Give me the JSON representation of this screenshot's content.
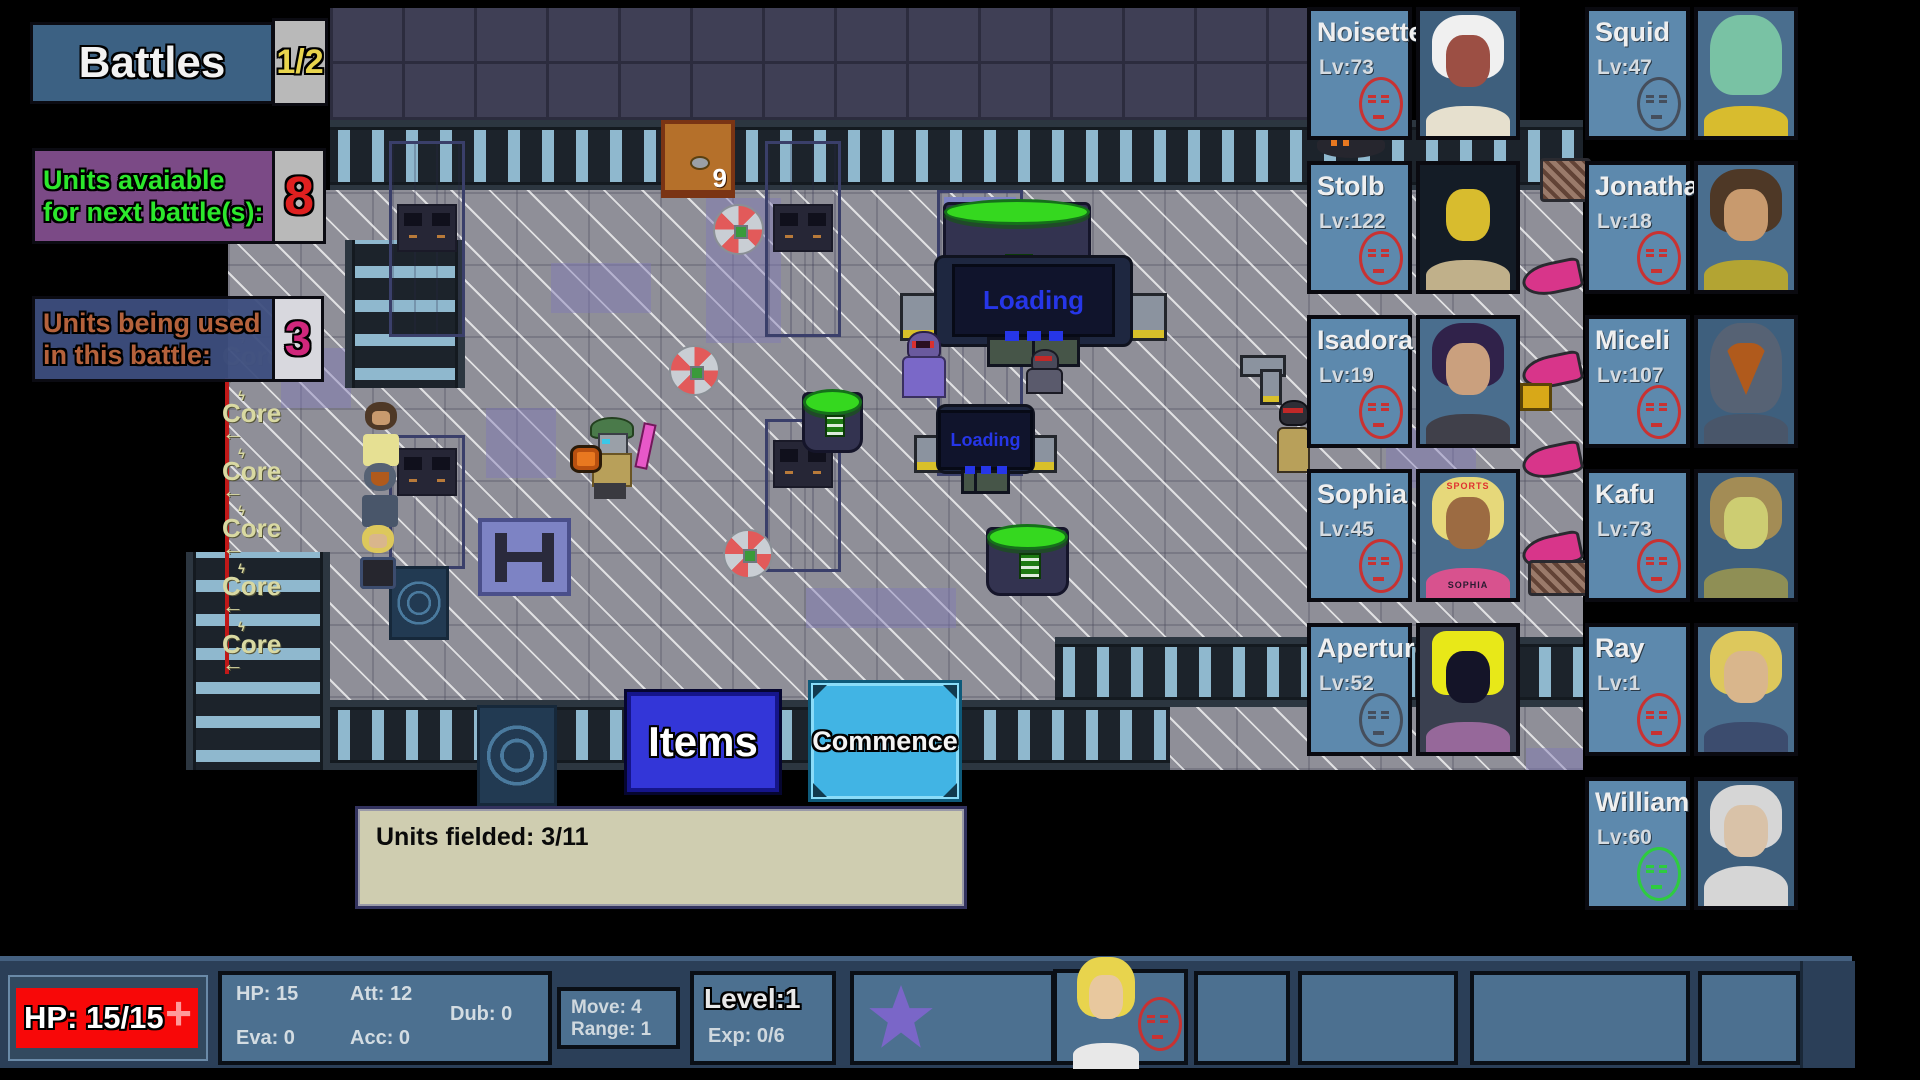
{
  "left_panels": {
    "battles": {
      "label": "Battles",
      "count": "1/2"
    },
    "available": {
      "line1": "Units avaiable",
      "line2": "for next battle(s):",
      "count": "8"
    },
    "in_battle": {
      "line1": "Units being used",
      "line2": "in this battle:",
      "count": "3"
    }
  },
  "map": {
    "core_label": "Core",
    "chest_number": "9",
    "loading_label": "Loading"
  },
  "actions": {
    "items": "Items",
    "commence": "Commence"
  },
  "status_box": {
    "units_fielded": "Units fielded: 3/11"
  },
  "roster": [
    {
      "name": "Noisette",
      "level": "Lv:73",
      "mood": "red",
      "portrait": {
        "bg": "#3e5f7d",
        "hair": "#f0f0f0",
        "face": "#9c4f44",
        "body": "#e6e0ce"
      }
    },
    {
      "name": "Squid",
      "level": "Lv:47",
      "mood": "gray",
      "portrait": {
        "bg": "#4a6e8e",
        "hair": "#79c2a4",
        "face": "#79c2a4",
        "body": "#d8bc2e"
      }
    },
    {
      "name": "Stolb",
      "level": "Lv:122",
      "mood": "red",
      "portrait": {
        "bg": "#141c26",
        "hair": "#141c26",
        "face": "#d8bc2e",
        "body": "#c0b08a"
      }
    },
    {
      "name": "Jonathan",
      "level": "Lv:18",
      "mood": "red",
      "portrait": {
        "bg": "#4a6e8e",
        "hair": "#4e3826",
        "face": "#c89a6e",
        "body": "#b3a433"
      }
    },
    {
      "name": "Isadora",
      "level": "Lv:19",
      "mood": "red",
      "portrait": {
        "bg": "#4a6e8e",
        "hair": "#30224a",
        "face": "#caa07e",
        "body": "#40404a"
      }
    },
    {
      "name": "Miceli",
      "level": "Lv:107",
      "mood": "red",
      "portrait": {
        "bg": "#3e5f7d",
        "hair": "#566274",
        "face": "#b05a1c",
        "body": "#49566a"
      }
    },
    {
      "name": "Sophia",
      "level": "Lv:45",
      "mood": "red",
      "portrait": {
        "bg": "#4a6e8e",
        "hair": "#e6d87a",
        "face": "#9c6b42",
        "body": "#d8528e"
      },
      "portrait_texts": {
        "top": "SPORTS",
        "bottom": "SOPHIA"
      }
    },
    {
      "name": "Kafu",
      "level": "Lv:73",
      "mood": "red",
      "portrait": {
        "bg": "#3e5f7d",
        "hair": "#a38c55",
        "face": "#cdcd72",
        "body": "#8f8f55"
      }
    },
    {
      "name": "Aperture",
      "level": "Lv:52",
      "mood": "gray",
      "portrait": {
        "bg": "#3a4050",
        "hair": "#e8e818",
        "face": "#141428",
        "body": "#96689a"
      }
    },
    {
      "name": "Ray",
      "level": "Lv:1",
      "mood": "red",
      "portrait": {
        "bg": "#4a6e8e",
        "hair": "#ddc85c",
        "face": "#d9b68c",
        "body": "#3c4c6e"
      }
    },
    {
      "name": "William",
      "level": "Lv:60",
      "mood": "green",
      "portrait": {
        "bg": "#3e5f7d",
        "hair": "#d6d6d6",
        "face": "#d9c2a8",
        "body": "#26262c"
      }
    }
  ],
  "bottom_bar": {
    "hp_bar": "HP: 15/15",
    "plus": "+",
    "stats": {
      "hp": "HP: 15",
      "att": "Att: 12",
      "dub": "Dub: 0",
      "eva": "Eva: 0",
      "acc": "Acc: 0"
    },
    "movement": {
      "move": "Move:  4",
      "range": "Range: 1"
    },
    "level": {
      "level": "Level:1",
      "exp": "Exp: 0/6"
    },
    "character_mood": "red",
    "character_portrait": {
      "bg": "#4c7090",
      "hair": "#e8d44d",
      "face": "#e8c89e",
      "body": "#e8e8e8"
    }
  },
  "colors": {
    "hp_bar_red": "#f80808",
    "mood_red": "#c83232",
    "mood_gray": "#454e5c",
    "mood_green": "#2ecc40",
    "panel_blue": "#5d89ad"
  }
}
